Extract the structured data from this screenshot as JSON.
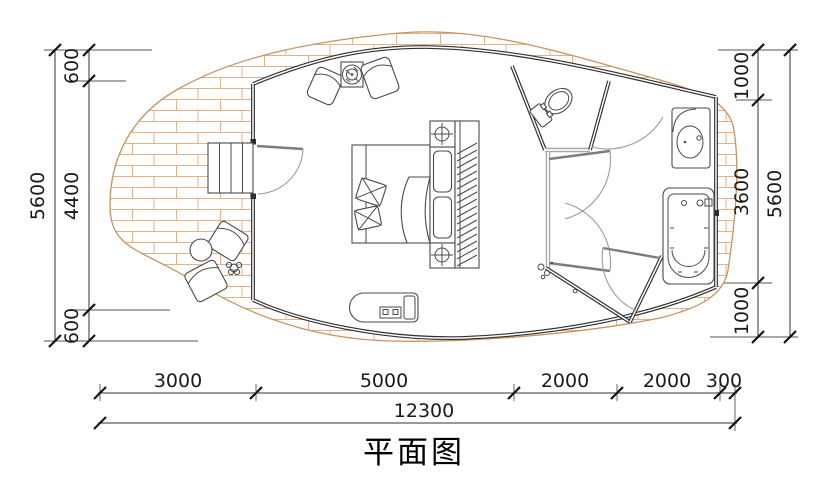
{
  "title": "平面图",
  "dimensions": {
    "left": {
      "segments": [
        "600",
        "4400",
        "600"
      ],
      "total": "5600"
    },
    "right": {
      "segments": [
        "1000",
        "3600",
        "1000"
      ],
      "total": "5600"
    },
    "bottom": {
      "segments": [
        "3000",
        "5000",
        "2000",
        "2000",
        "300"
      ],
      "total": "12300"
    }
  },
  "colors": {
    "wall": "#2f2f2f",
    "partition": "#a6a6a6",
    "deck_outline": "#c9935f",
    "deck_brick": "#e2b28b",
    "dimension_text": "#1a1a1a"
  },
  "furniture": [
    "entry-steps",
    "outdoor-armchair",
    "outdoor-side-table",
    "potted-plant",
    "lounge-armchair",
    "stove-table",
    "double-bed",
    "bedside-table",
    "wardrobe",
    "daybed",
    "toilet",
    "shower",
    "washbasin",
    "bathtub"
  ]
}
